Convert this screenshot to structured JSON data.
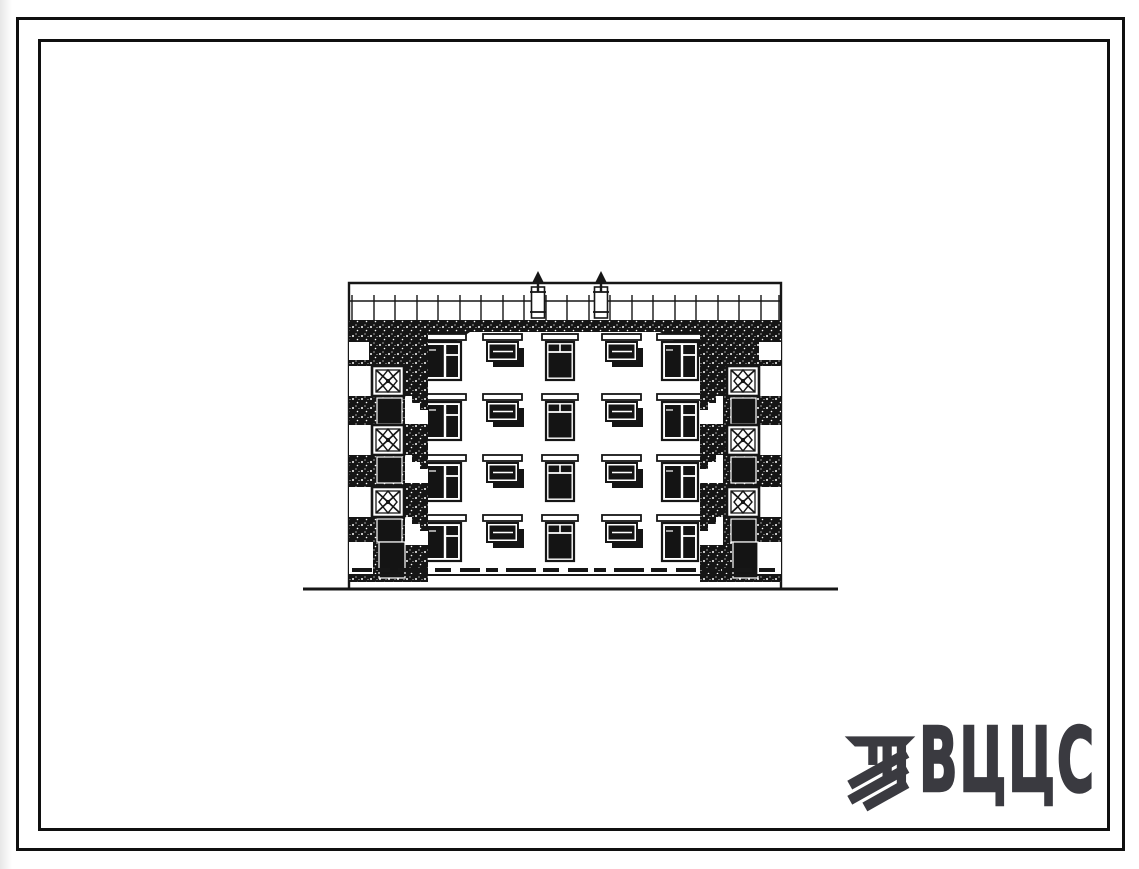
{
  "page": {
    "background": "#ffffff",
    "frame_color": "#101010"
  },
  "logo": {
    "text": "ВЦЦС",
    "color": "#3a3a40",
    "icon": "hatched-stripes-emblem-icon"
  },
  "drawing": {
    "kind": "building facade elevation (typical design series, scanned ink drawing)",
    "ink_color": "#161616",
    "floors": 4,
    "window_columns": 5,
    "roof_vents": 2,
    "balcony_lattice_panels_per_side": 3
  }
}
